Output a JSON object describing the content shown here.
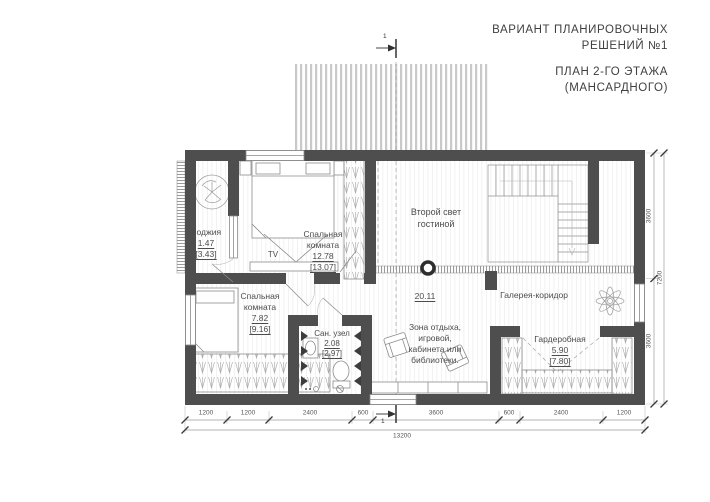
{
  "header": {
    "variant_line1": "ВАРИАНТ ПЛАНИРОВОЧНЫХ",
    "variant_line2": "РЕШЕНИЙ №1",
    "plan_line1": "ПЛАН 2-ГО ЭТАЖА",
    "plan_line2": "(МАНСАРДНОГО)"
  },
  "axis": {
    "label": "1"
  },
  "rooms": {
    "loggia": {
      "name": "Лоджия",
      "area": "1.47",
      "area_alt": "[3.43]"
    },
    "bedroom1": {
      "name": "Спальная комната",
      "area": "12.78",
      "area_alt": "[13.07]"
    },
    "second_light": {
      "name": "Второй свет гостиной"
    },
    "gallery": {
      "name": "Галерея-коридор",
      "area": "20.11"
    },
    "bedroom2": {
      "name": "Спальная комната",
      "area": "7.82",
      "area_alt": "[9.16]"
    },
    "bathroom": {
      "name": "Сан. узел",
      "area": "2.08",
      "area_alt": "[2.97]"
    },
    "lounge": {
      "lines": [
        "Зона отдыха,",
        "игровой,",
        "кабинета или",
        "библиотеки."
      ]
    },
    "wardrobe": {
      "name": "Гардеробная",
      "area": "5.90",
      "area_alt": "[7.80]"
    }
  },
  "furniture": {
    "tv": "TV"
  },
  "dimensions": {
    "bottom": [
      "1200",
      "1200",
      "2400",
      "600",
      "3600",
      "600",
      "2400",
      "1200"
    ],
    "bottom_total": "13200",
    "right": [
      "3600",
      "3600"
    ],
    "right_total": "7200"
  },
  "colors": {
    "wall": "#4e4e4e",
    "text": "#4a4a4a",
    "line": "#8c8c8c"
  }
}
